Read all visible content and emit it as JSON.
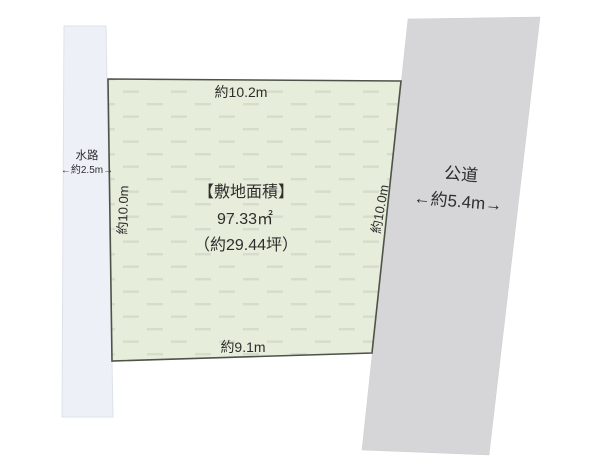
{
  "colors": {
    "background": "#ffffff",
    "plot_fill": "#e6edda",
    "plot_border": "#4e5349",
    "plot_dash": "#d6dccb",
    "waterway_fill": "#edf1f7",
    "road_fill": "#d6d6d8",
    "text": "#2e2e2e"
  },
  "plot": {
    "area_title": "【敷地面積】",
    "area_sqm": "97.33㎡",
    "area_tsubo": "（約29.44坪）",
    "dim_top": "約10.2m",
    "dim_left": "約10.0m",
    "dim_right": "約10.0m",
    "dim_bottom": "約9.1m"
  },
  "waterway": {
    "label": "水路",
    "width": "←約2.5m→"
  },
  "road": {
    "label": "公道",
    "width": "←約5.4m→"
  }
}
